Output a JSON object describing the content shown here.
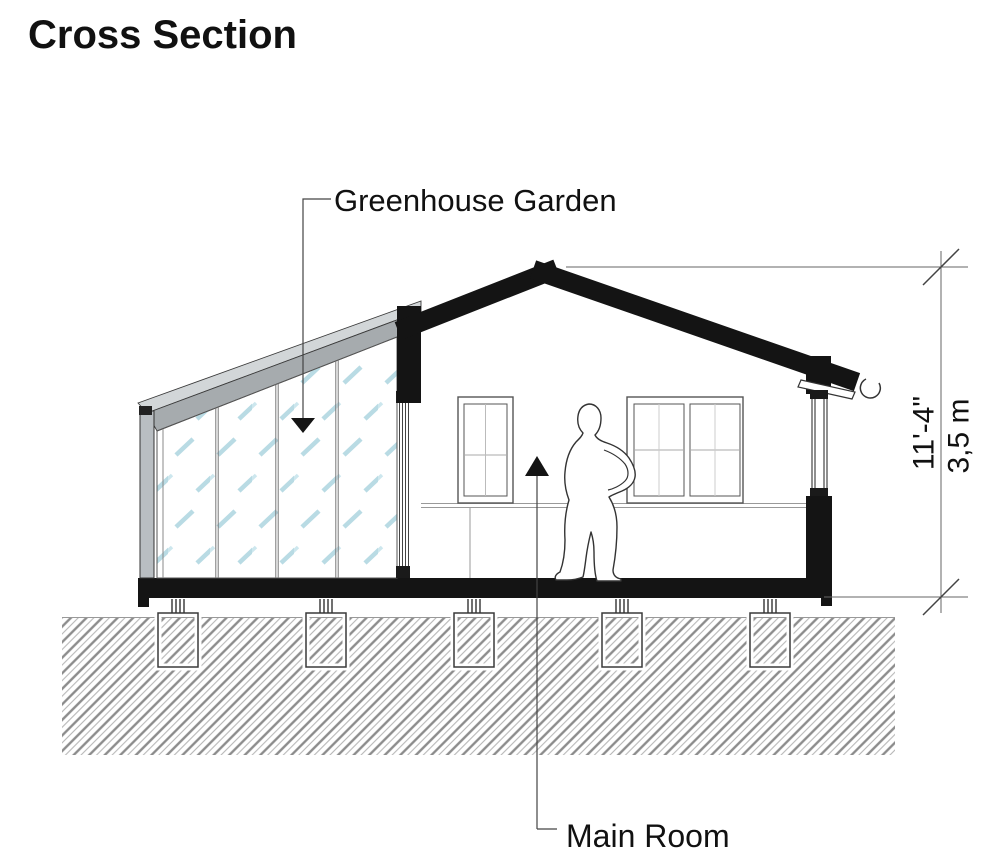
{
  "title": "Cross Section",
  "annotations": {
    "greenhouse_label": "Greenhouse Garden",
    "main_room_label": "Main Room"
  },
  "dimensions": {
    "height_imperial": "11'-4\"",
    "height_metric": "3,5 m"
  },
  "drawing": {
    "type": "architectural-cross-section",
    "elements": [
      "gable roof",
      "greenhouse glazed lean-to",
      "main room",
      "two windows",
      "standing person silhouette",
      "pier foundations",
      "hatched ground"
    ]
  },
  "colors": {
    "ink": "#141414",
    "thin_line": "#555555",
    "glass_streak": "#b9dbe4",
    "frame_gray_light": "#d2d6d8",
    "frame_gray_dark": "#a6abae",
    "post_gray": "#b9bec2",
    "ground_hatch": "#8c8c8c"
  }
}
